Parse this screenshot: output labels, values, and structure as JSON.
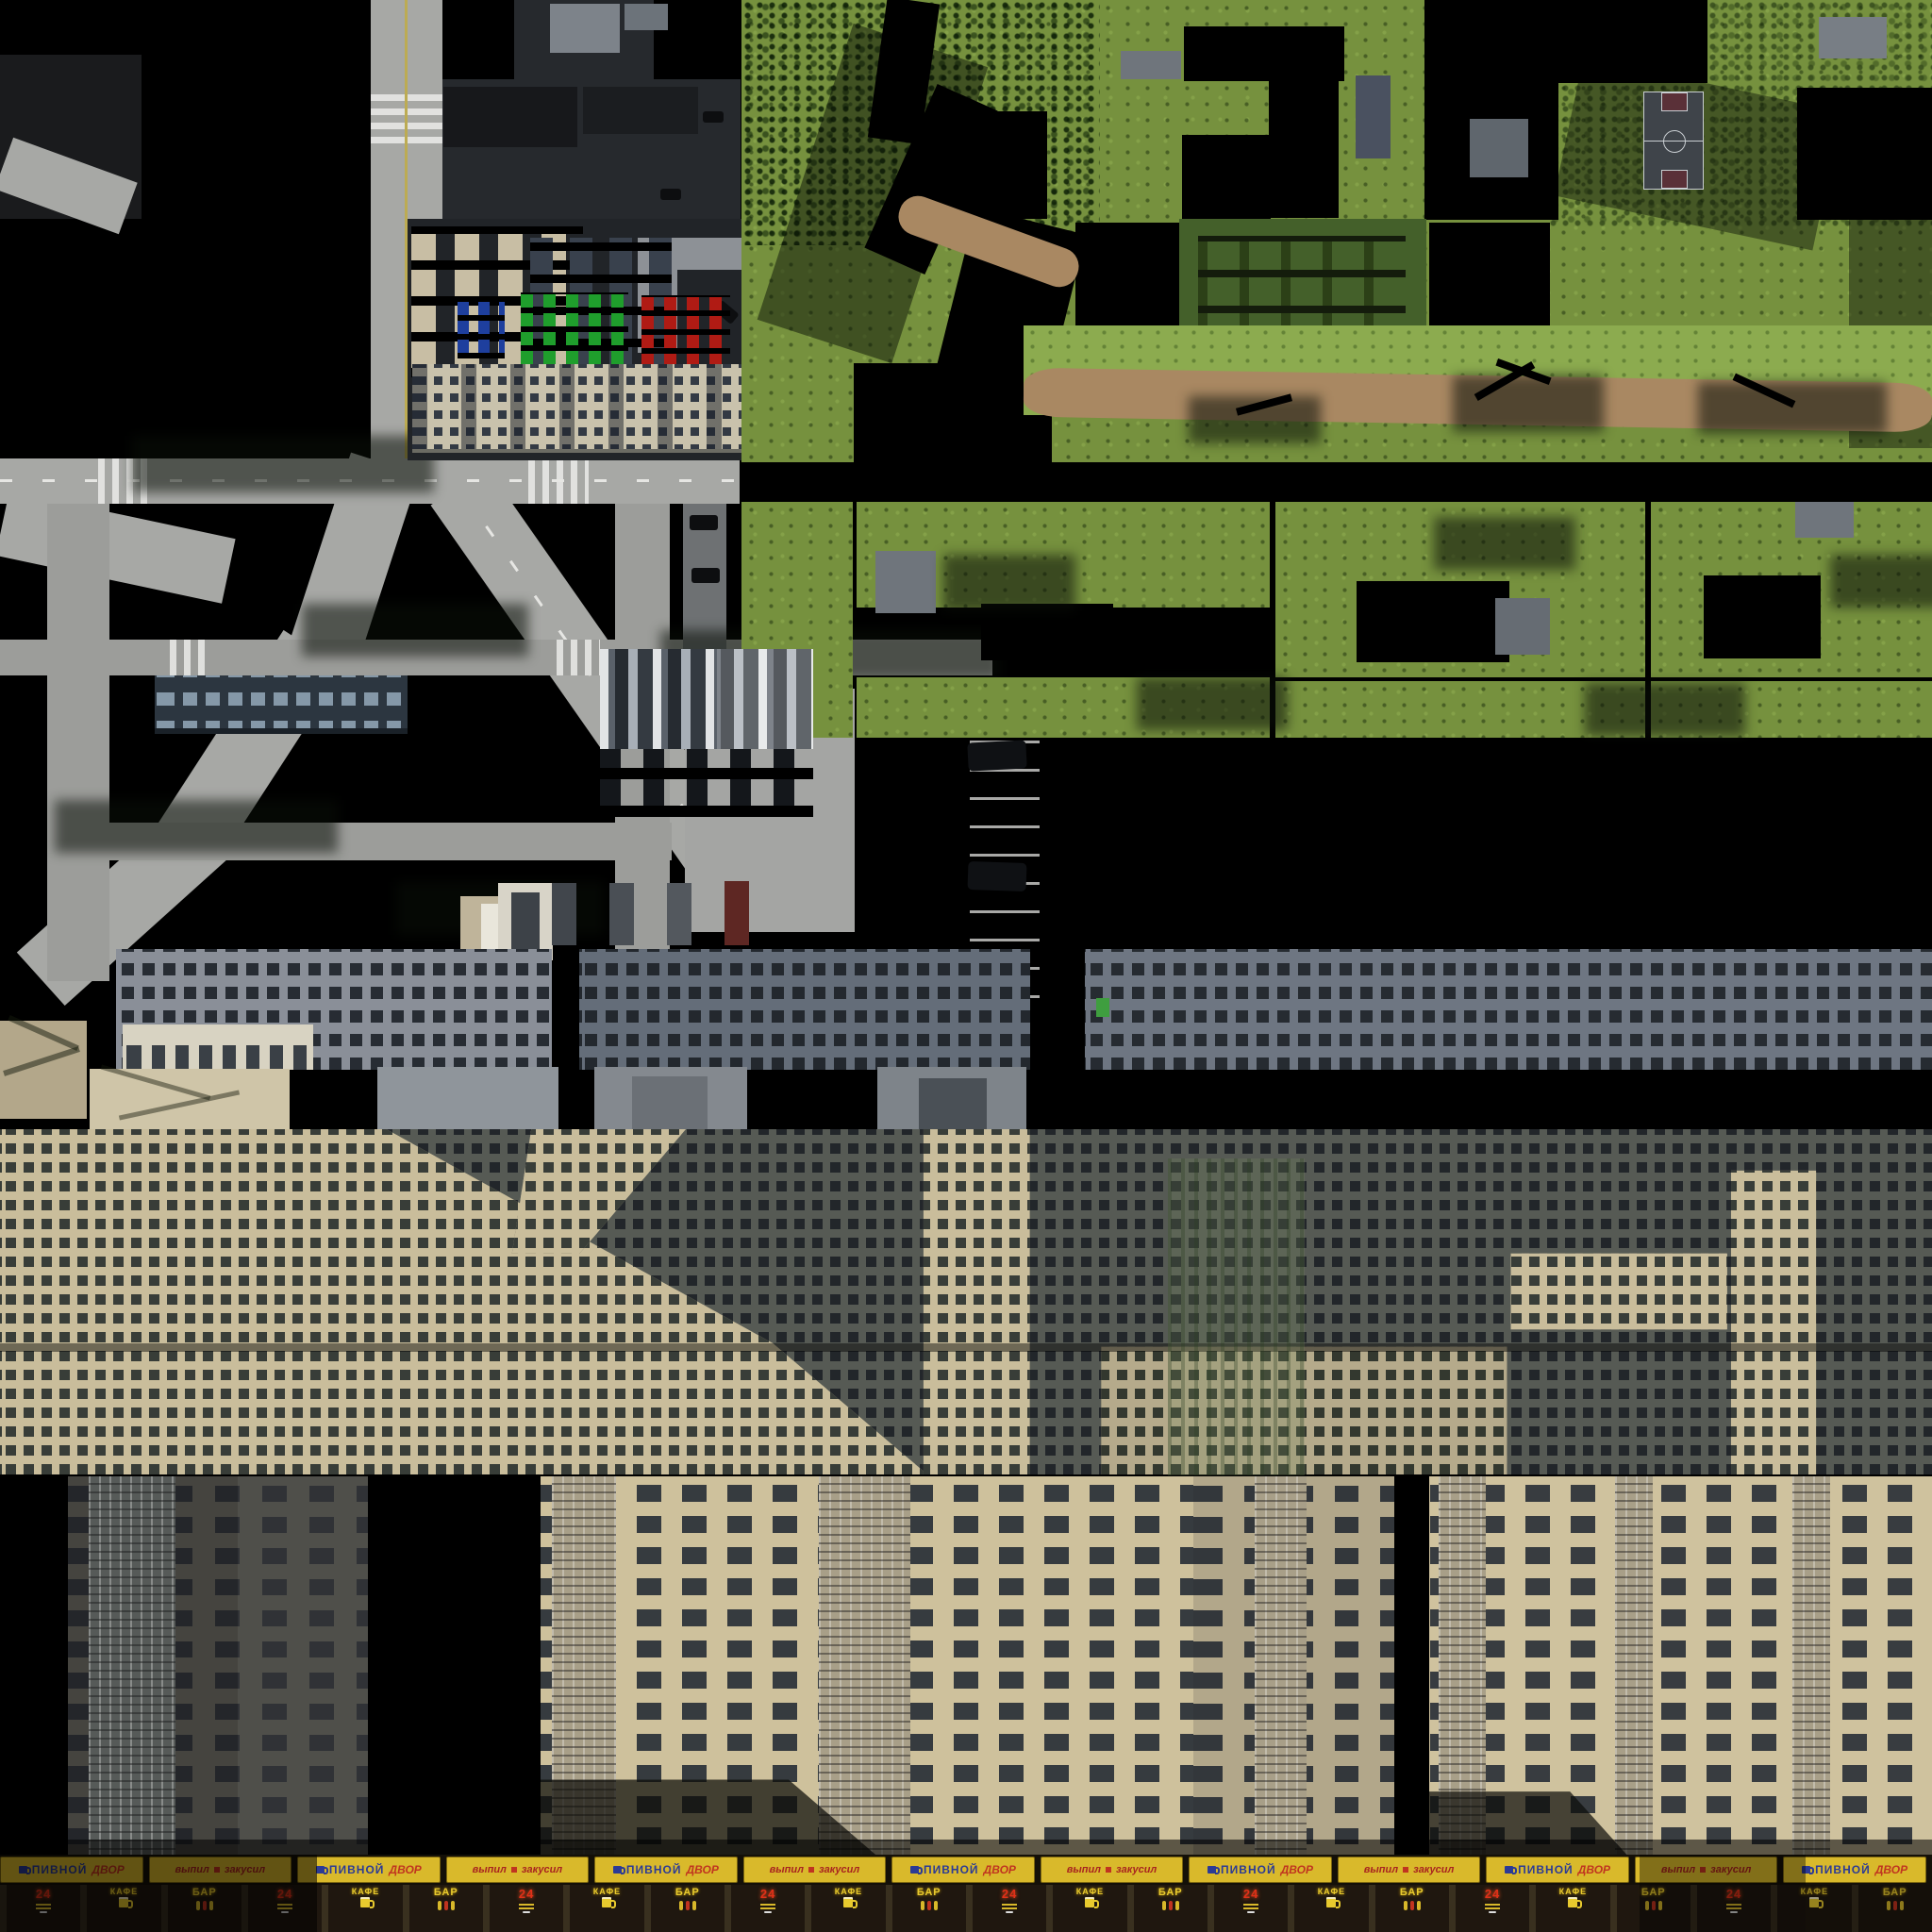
{
  "palette": {
    "background": "#000000",
    "road_light": "#a7a8a5",
    "road_dashes": "#e6e6e3",
    "road_centerline_yellow": "#bcab53",
    "asphalt_dark": "#23262a",
    "walkway_gray": "#8d9196",
    "grass_green": "#76913e",
    "grass_hill_light": "#8cab4f",
    "dirt_path_tan": "#a98862",
    "court_floor": "#3f444a",
    "court_lines": "#c9ced2",
    "court_key_red": "#5a3038",
    "facade_khrushchyovka": "#c9c2ac",
    "facade_blue_gray": "#8a8f98",
    "facade_panel_shadow": "#565a54",
    "facade_panel_sunlit": "#c9bd9b",
    "tower_beige_sunlit": "#cec19c",
    "tower_dark": "#45443f",
    "window_dark": "#23272b",
    "banner_yellow": "#d9b92b",
    "banner_blue_text": "#2b3a96",
    "banner_red_text": "#c03420",
    "neon_yellow": "#e8ca2e",
    "neon_red": "#e03018",
    "car_blue": "#1e3f9e",
    "car_green": "#1f9e2c",
    "car_red": "#b01b14",
    "car_beige": "#c8bea4"
  },
  "icons": {
    "beer_mug": "beer-mug-icon",
    "patron_figures": "patron-figures-icon",
    "menu_board": "menu-lines-icon"
  },
  "storefront": {
    "banner_cells": [
      {
        "kind": "pivnoy",
        "w1": "ПИВНОЙ",
        "w2": "ДВОР"
      },
      {
        "kind": "vypil",
        "w1": "выпил",
        "w2": "закусил"
      },
      {
        "kind": "pivnoy",
        "w1": "ПИВНОЙ",
        "w2": "ДВОР"
      },
      {
        "kind": "vypil",
        "w1": "выпил",
        "w2": "закусил"
      },
      {
        "kind": "pivnoy",
        "w1": "ПИВНОЙ",
        "w2": "ДВОР"
      },
      {
        "kind": "vypil",
        "w1": "выпил",
        "w2": "закусил"
      },
      {
        "kind": "pivnoy",
        "w1": "ПИВНОЙ",
        "w2": "ДВОР"
      },
      {
        "kind": "vypil",
        "w1": "выпил",
        "w2": "закусил"
      },
      {
        "kind": "pivnoy",
        "w1": "ПИВНОЙ",
        "w2": "ДВОР"
      },
      {
        "kind": "vypil",
        "w1": "выпил",
        "w2": "закусил"
      },
      {
        "kind": "pivnoy",
        "w1": "ПИВНОЙ",
        "w2": "ДВОР"
      },
      {
        "kind": "vypil",
        "w1": "выпил",
        "w2": "закусил"
      },
      {
        "kind": "pivnoy",
        "w1": "ПИВНОЙ",
        "w2": "ДВОР"
      }
    ],
    "sign_cells": [
      {
        "kind": "h24",
        "label": "24"
      },
      {
        "kind": "kafe",
        "label": "КАФЕ"
      },
      {
        "kind": "bar",
        "label": "БАР"
      },
      {
        "kind": "h24",
        "label": "24"
      },
      {
        "kind": "kafe",
        "label": "КАФЕ"
      },
      {
        "kind": "bar",
        "label": "БАР"
      },
      {
        "kind": "h24",
        "label": "24"
      },
      {
        "kind": "kafe",
        "label": "КАФЕ"
      },
      {
        "kind": "bar",
        "label": "БАР"
      },
      {
        "kind": "h24",
        "label": "24"
      },
      {
        "kind": "kafe",
        "label": "КАФЕ"
      },
      {
        "kind": "bar",
        "label": "БАР"
      },
      {
        "kind": "h24",
        "label": "24"
      },
      {
        "kind": "kafe",
        "label": "КАФЕ"
      },
      {
        "kind": "bar",
        "label": "БАР"
      },
      {
        "kind": "h24",
        "label": "24"
      },
      {
        "kind": "kafe",
        "label": "КАФЕ"
      },
      {
        "kind": "bar",
        "label": "БАР"
      },
      {
        "kind": "h24",
        "label": "24"
      },
      {
        "kind": "kafe",
        "label": "КАФЕ"
      },
      {
        "kind": "bar",
        "label": "БАР"
      },
      {
        "kind": "h24",
        "label": "24"
      },
      {
        "kind": "kafe",
        "label": "КАФЕ"
      },
      {
        "kind": "bar",
        "label": "БАР"
      }
    ]
  }
}
